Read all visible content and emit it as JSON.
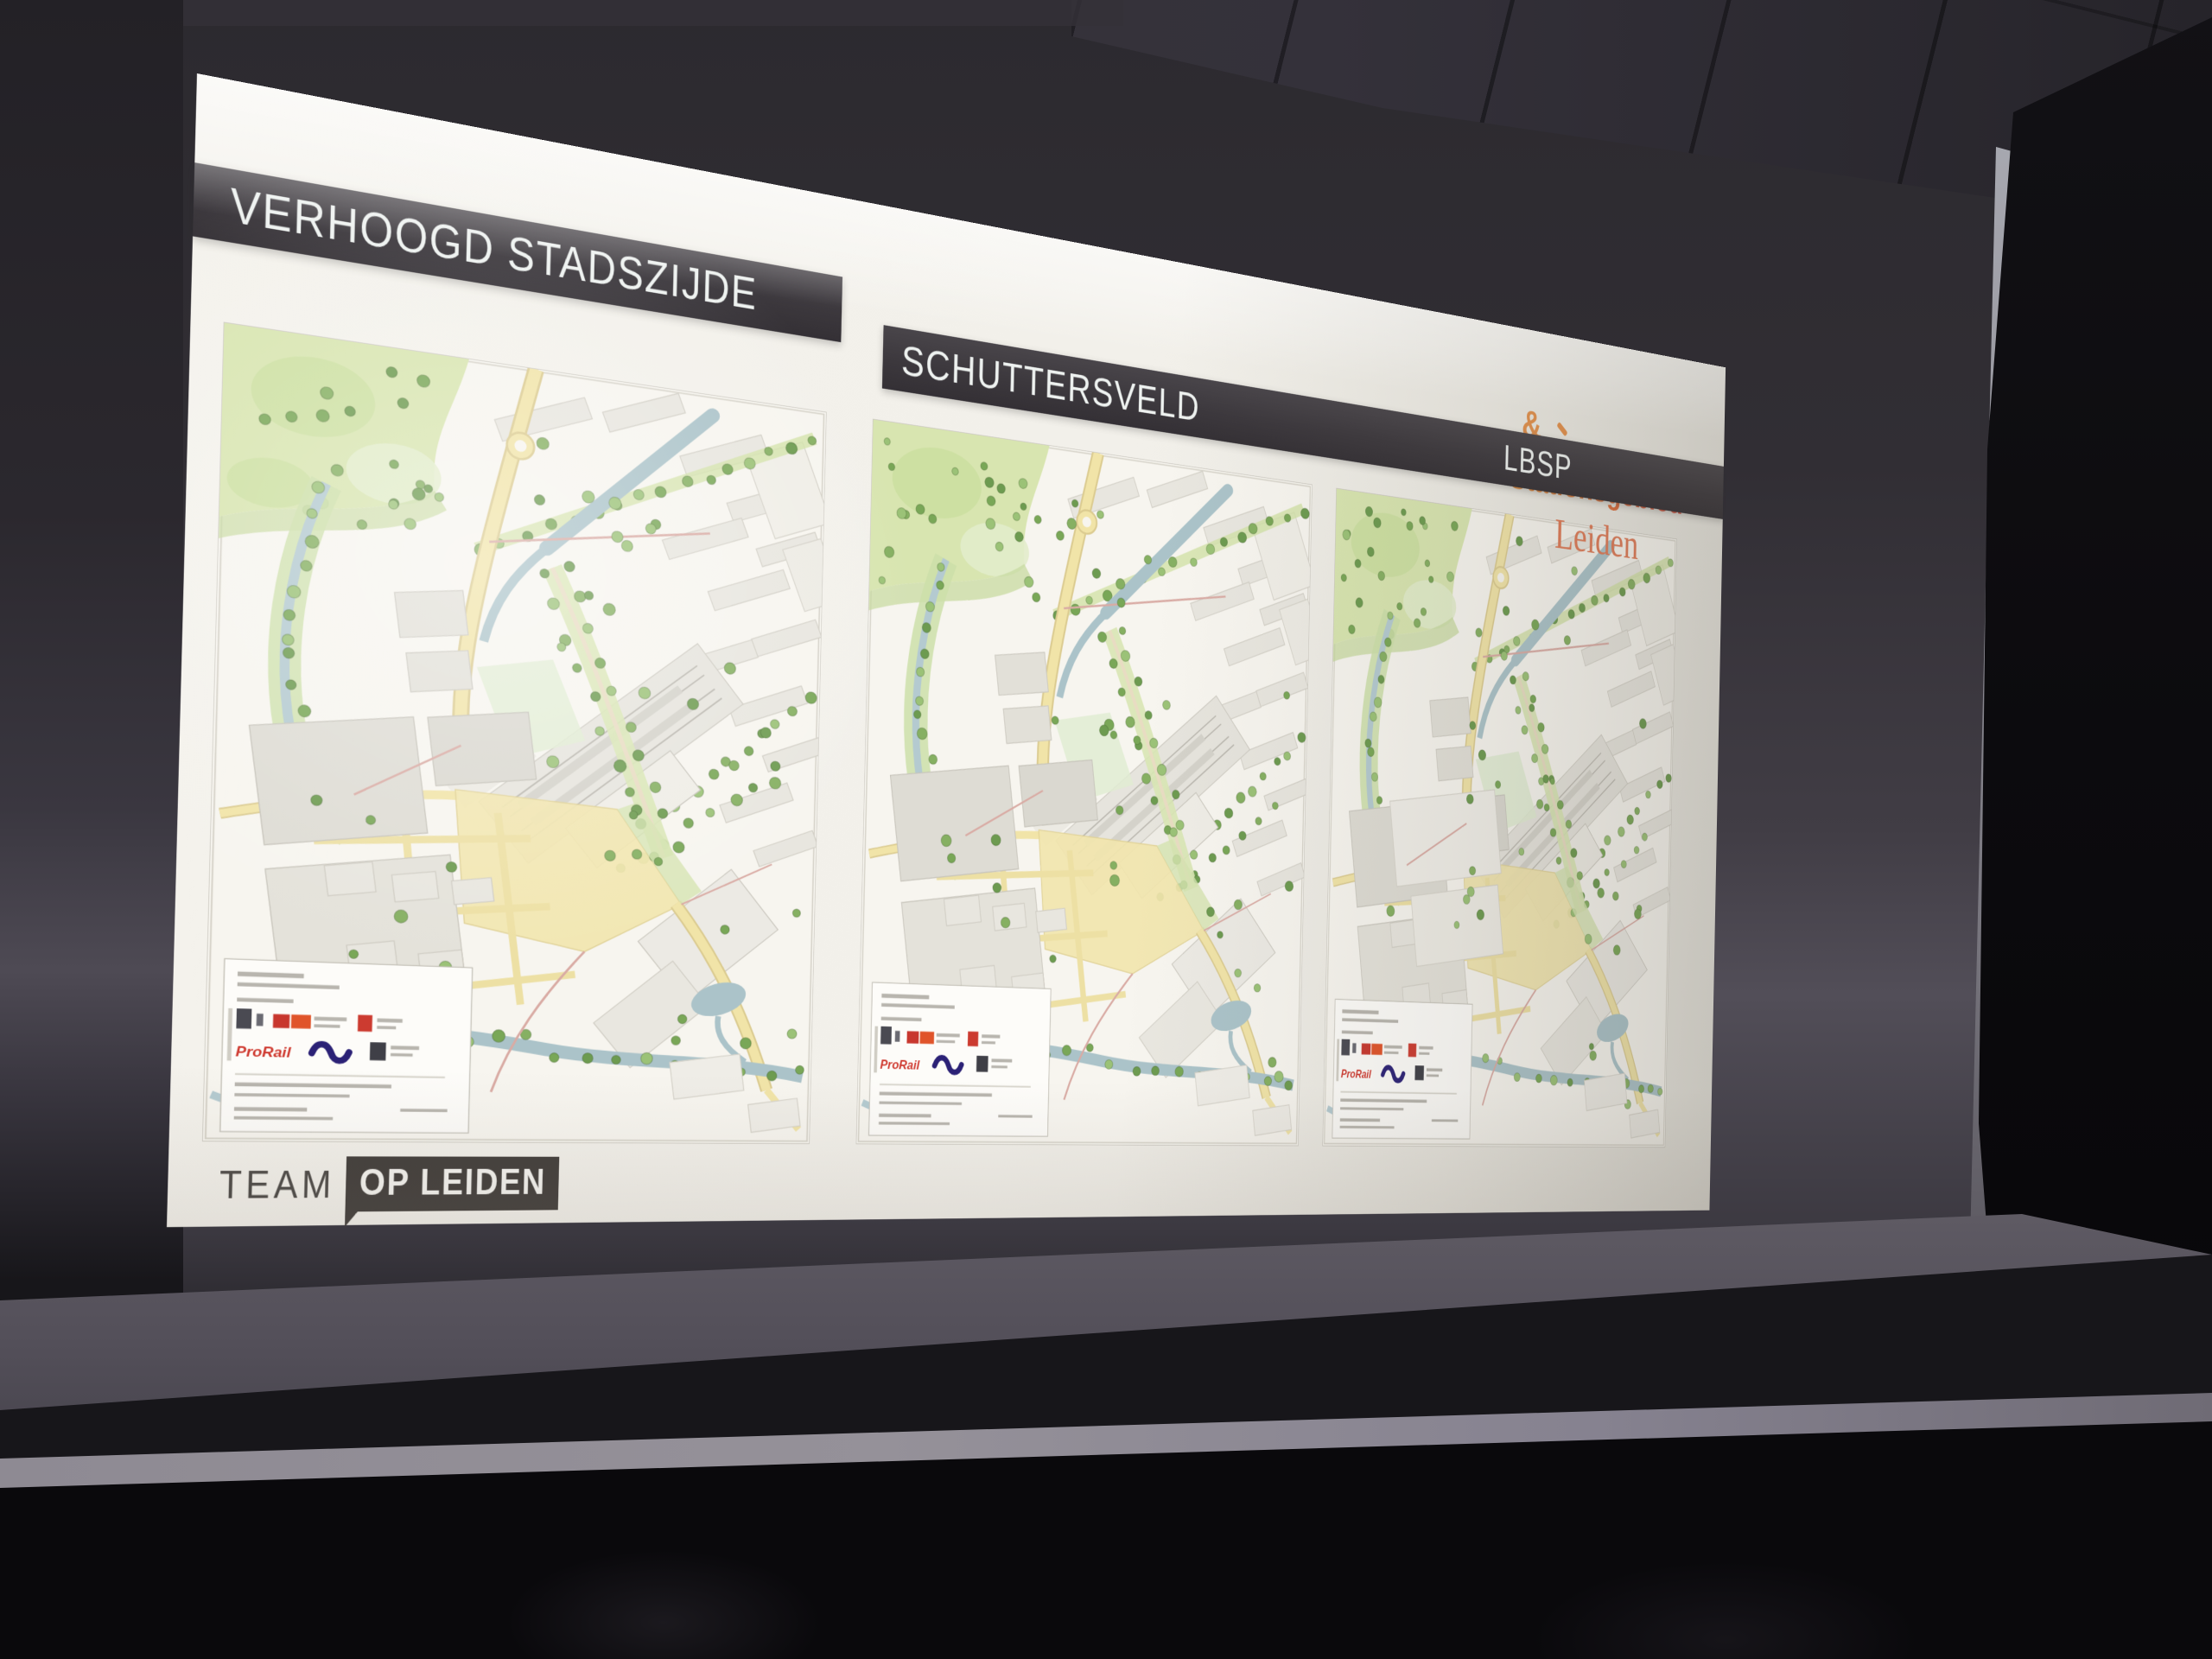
{
  "slide": {
    "banner_labels": [
      {
        "id": "verhoogd-stadszijde",
        "label": "VERHOOGD STADSZIJDE"
      },
      {
        "id": "schuttersveld",
        "label": "SCHUTTERSVELD"
      },
      {
        "id": "lbsp",
        "label": "LBSP"
      }
    ],
    "stationsgebied_logo": {
      "ampersand": "&",
      "line1": "Stationsgebied",
      "line2": "Leiden"
    },
    "team_logo": {
      "prefix": "TEAM",
      "badge": "OP LEIDEN"
    },
    "maps": [
      {
        "id": "verhoogd-stadszijde",
        "title_block": {
          "prorail_label": "ProRail"
        }
      },
      {
        "id": "schuttersveld",
        "title_block": {
          "prorail_label": "ProRail"
        }
      },
      {
        "id": "lbsp",
        "title_block": {
          "prorail_label": "ProRail"
        }
      }
    ]
  },
  "colors": {
    "banner_bg": "#3c383d",
    "banner_text": "#eef2f0",
    "slide_bg": "#f2f0ea",
    "logo_orange": "#e8923e",
    "logo_red": "#d6453f",
    "logo_leiden": "#de7a57",
    "map_green": "#d8e5b0",
    "map_green_band": "#cddfa9",
    "map_tree": "#86b062",
    "map_water": "#abc3c9",
    "map_yellow": "#f1e4a8",
    "map_yellow_casing": "#dbcb90",
    "map_building": "#e8e6df",
    "map_building_dark": "#dedcd4",
    "map_rail": "#e6e4dd",
    "map_red_road": "#d9aba4",
    "prorail_red": "#cf3a30",
    "ns_blue": "#2b2176"
  }
}
